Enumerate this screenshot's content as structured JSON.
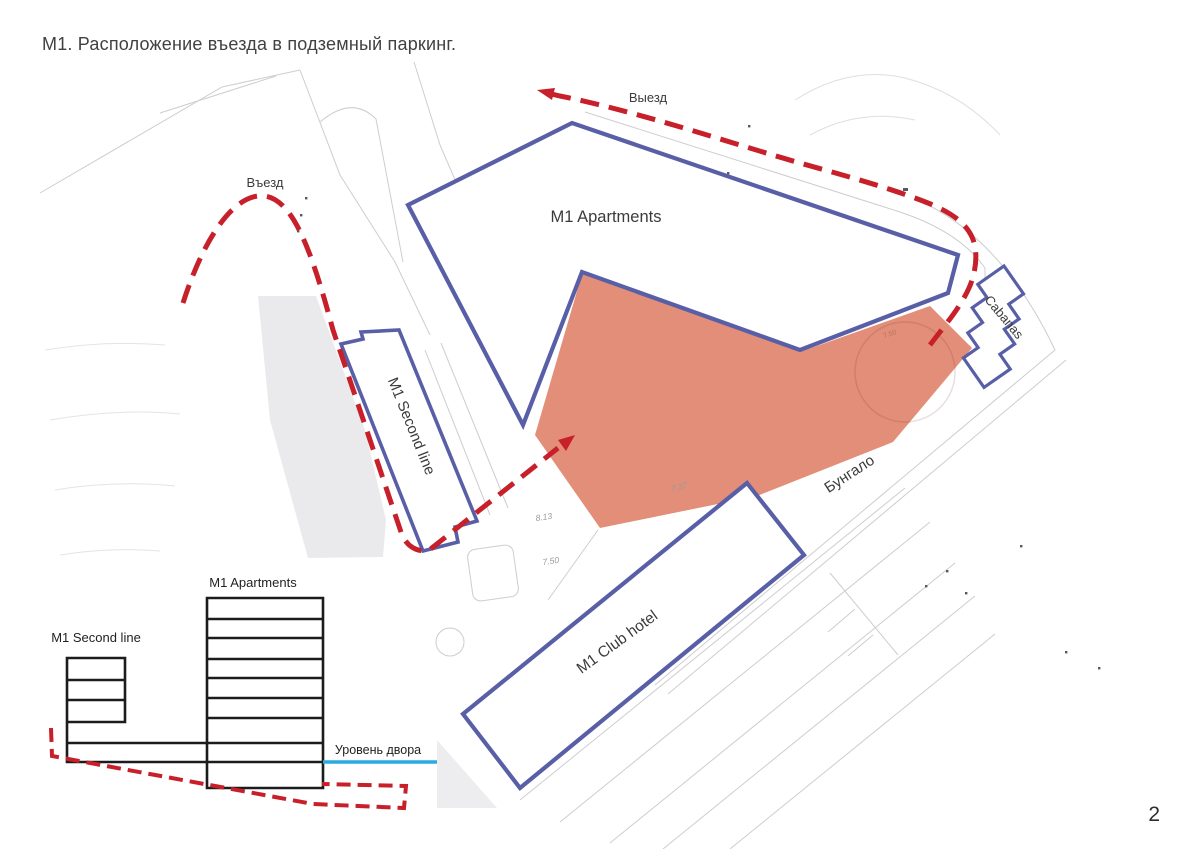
{
  "title": "М1. Расположение въезда в подземный паркинг.",
  "page_number": "2",
  "site_plan": {
    "labels": {
      "entrance": "Въезд",
      "exit": "Выезд",
      "apartments": "M1 Apartments",
      "second_line": "M1 Second line",
      "club_hotel": "M1 Club hotel",
      "cabanas": "Cabanas",
      "bungalow": "Бунгало"
    },
    "elevation_marks": [
      "8.13",
      "7.50",
      "7.37",
      "7.50"
    ],
    "colors": {
      "building_outline": "#595fa6",
      "route": "#c7202a",
      "courtyard_fill": "#e28e78"
    }
  },
  "section_diagram": {
    "labels": {
      "apartments": "M1 Apartments",
      "second_line": "M1 Second line",
      "yard_level": "Уровень двора"
    },
    "colors": {
      "structure": "#1c1c1c",
      "yard_level_line": "#29abe2",
      "ramp": "#c7202a"
    }
  }
}
